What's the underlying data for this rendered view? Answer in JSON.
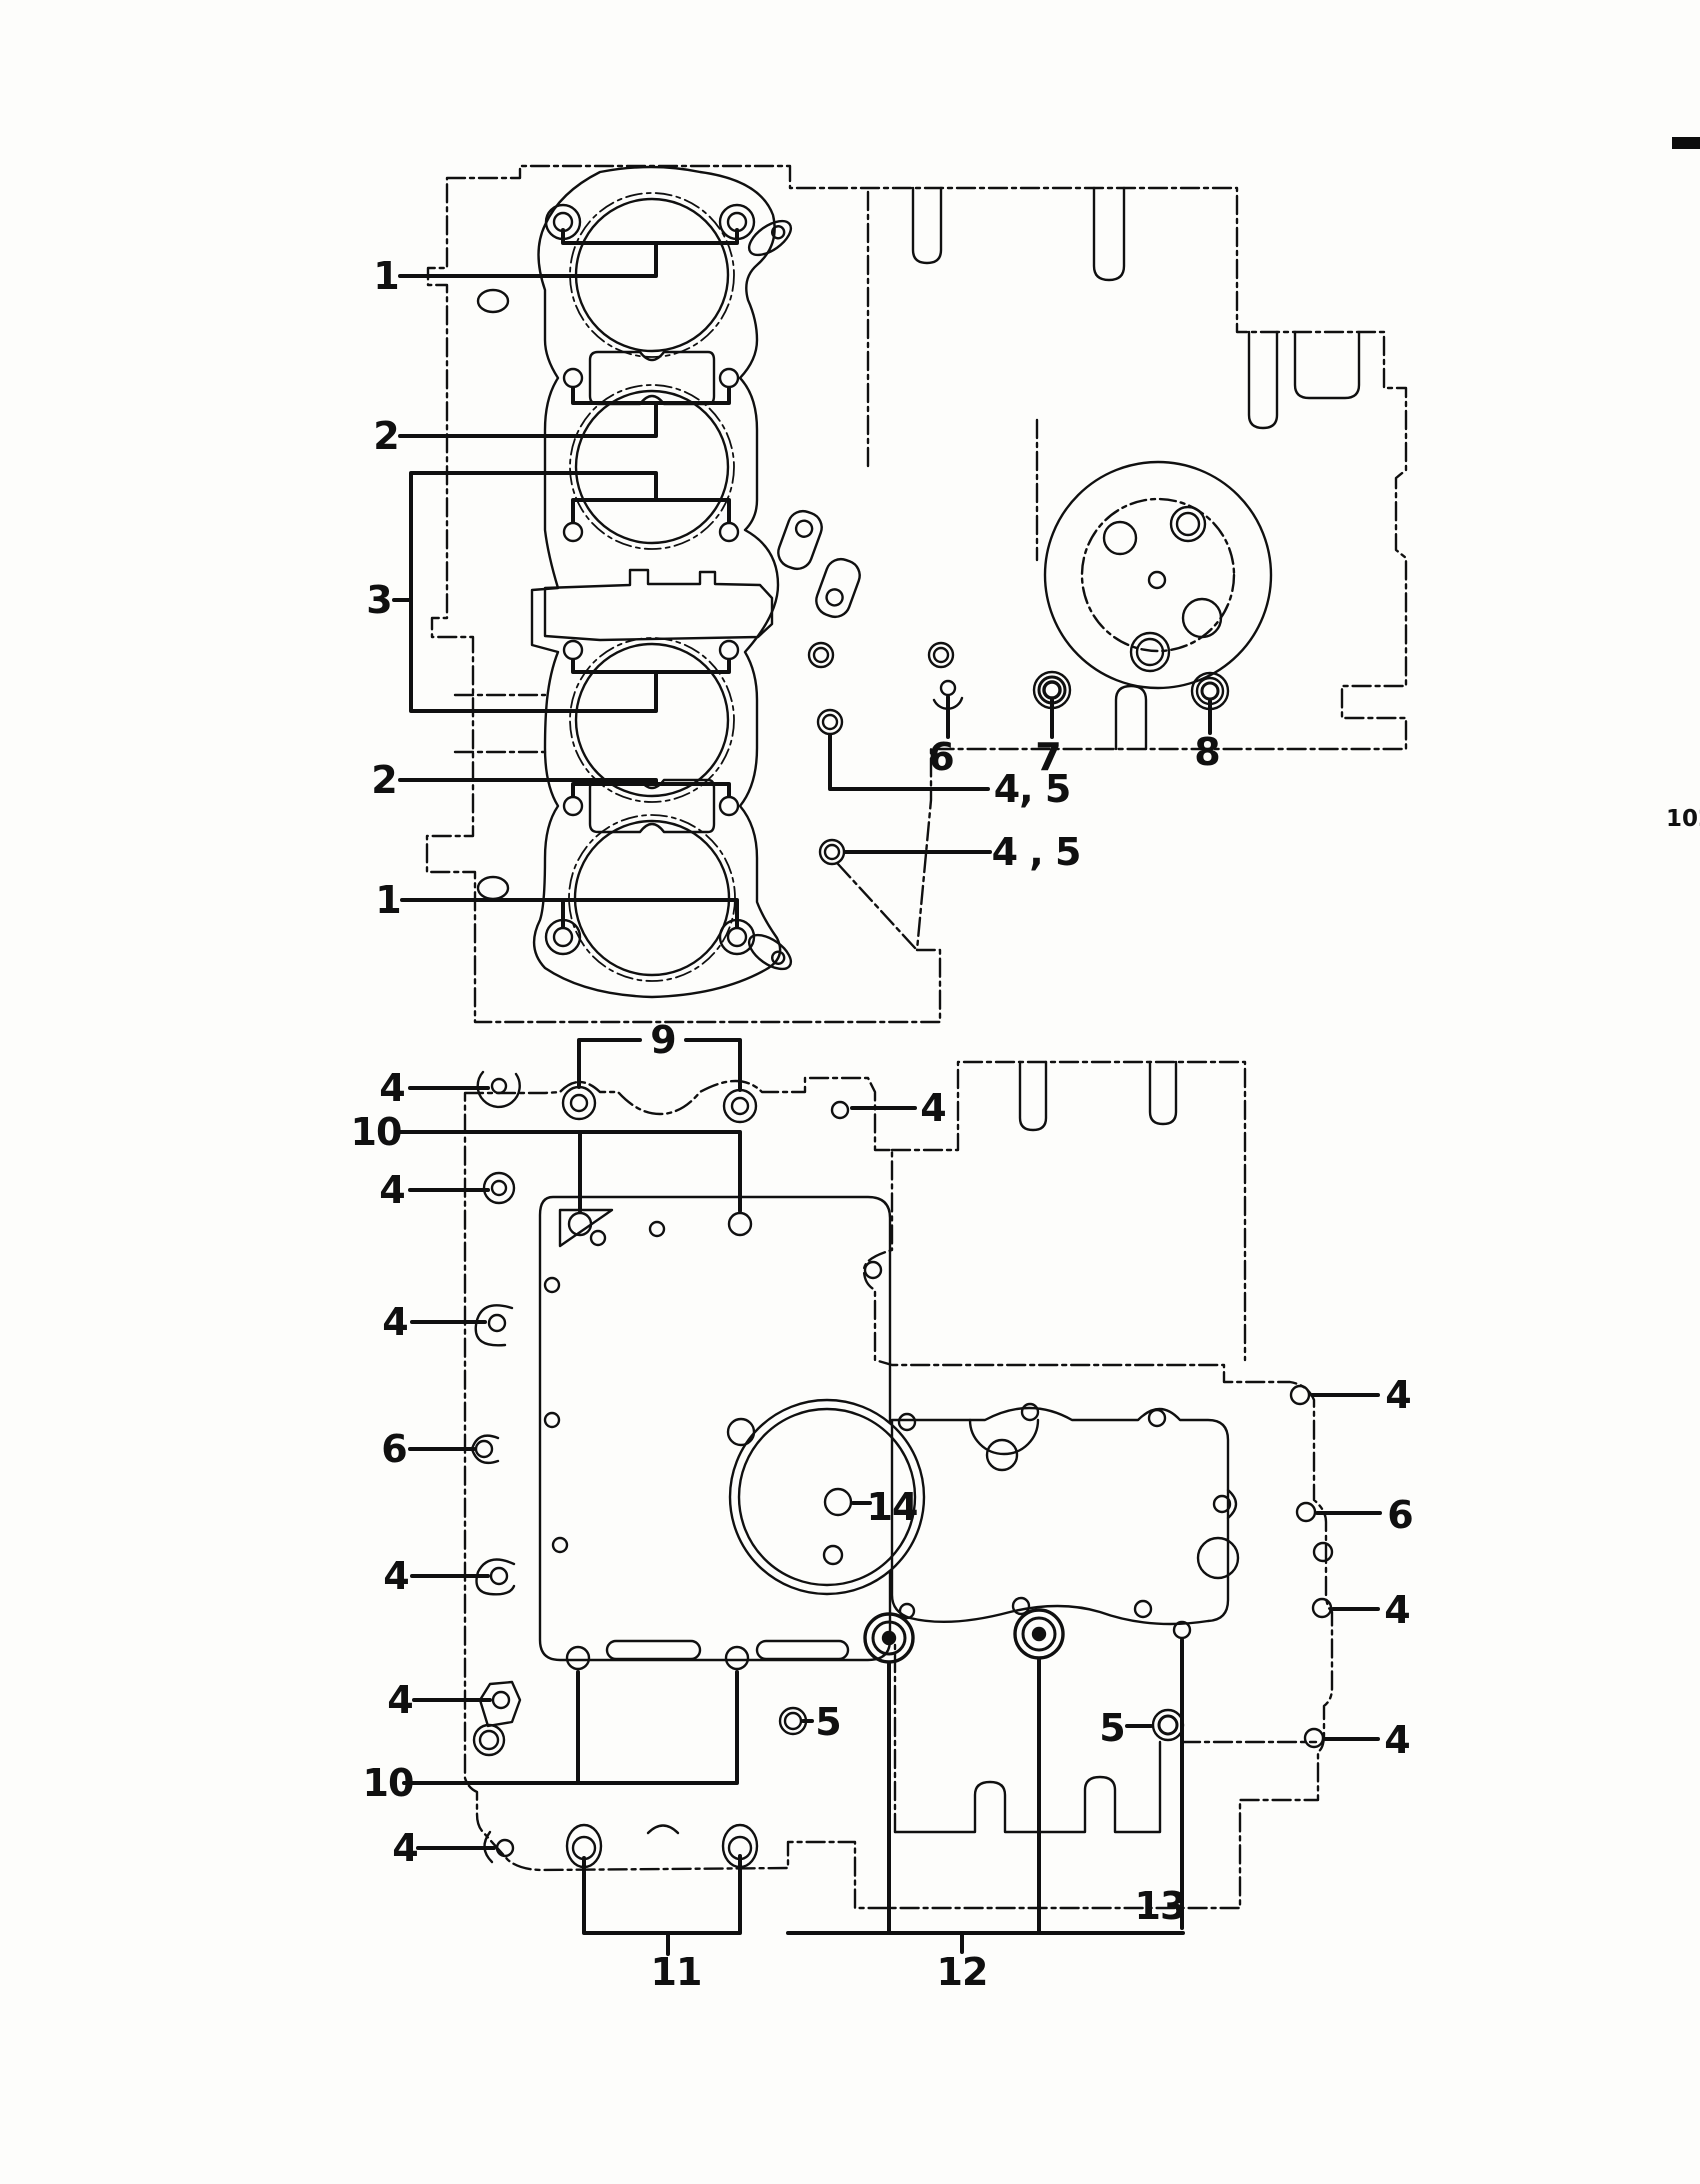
{
  "page": {
    "number": "102"
  },
  "marks": {
    "registration_dash": "black-dash-right-edge"
  },
  "diagrams": {
    "top": {
      "name": "cylinder-head-gasket-and-upper-crankcase",
      "callouts": [
        {
          "label": "1",
          "x": 386,
          "y": 276
        },
        {
          "label": "2",
          "x": 386,
          "y": 436
        },
        {
          "label": "3",
          "x": 379,
          "y": 600
        },
        {
          "label": "2",
          "x": 384,
          "y": 780
        },
        {
          "label": "1",
          "x": 388,
          "y": 900
        },
        {
          "label": "6",
          "x": 941,
          "y": 757
        },
        {
          "label": "7",
          "x": 1048,
          "y": 757
        },
        {
          "label": "8",
          "x": 1207,
          "y": 752
        },
        {
          "label": "4, 5",
          "x": 1032,
          "y": 789
        },
        {
          "label": "4 , 5",
          "x": 1036,
          "y": 852
        }
      ]
    },
    "bottom": {
      "name": "lower-crankcase-and-oil-pan-gasket",
      "callouts": [
        {
          "label": "9",
          "x": 663,
          "y": 1040
        },
        {
          "label": "4",
          "x": 392,
          "y": 1088
        },
        {
          "label": "4",
          "x": 933,
          "y": 1108
        },
        {
          "label": "10",
          "x": 376,
          "y": 1132
        },
        {
          "label": "4",
          "x": 392,
          "y": 1190
        },
        {
          "label": "4",
          "x": 395,
          "y": 1322
        },
        {
          "label": "6",
          "x": 394,
          "y": 1449
        },
        {
          "label": "4",
          "x": 396,
          "y": 1576
        },
        {
          "label": "4",
          "x": 400,
          "y": 1700
        },
        {
          "label": "10",
          "x": 388,
          "y": 1783
        },
        {
          "label": "4",
          "x": 405,
          "y": 1848
        },
        {
          "label": "14",
          "x": 892,
          "y": 1507
        },
        {
          "label": "5",
          "x": 828,
          "y": 1722
        },
        {
          "label": "5",
          "x": 1112,
          "y": 1728
        },
        {
          "label": "4",
          "x": 1398,
          "y": 1395
        },
        {
          "label": "6",
          "x": 1400,
          "y": 1515
        },
        {
          "label": "4",
          "x": 1397,
          "y": 1610
        },
        {
          "label": "4",
          "x": 1397,
          "y": 1740
        },
        {
          "label": "13",
          "x": 1160,
          "y": 1906
        },
        {
          "label": "11",
          "x": 676,
          "y": 1972
        },
        {
          "label": "12",
          "x": 962,
          "y": 1972
        }
      ]
    }
  }
}
